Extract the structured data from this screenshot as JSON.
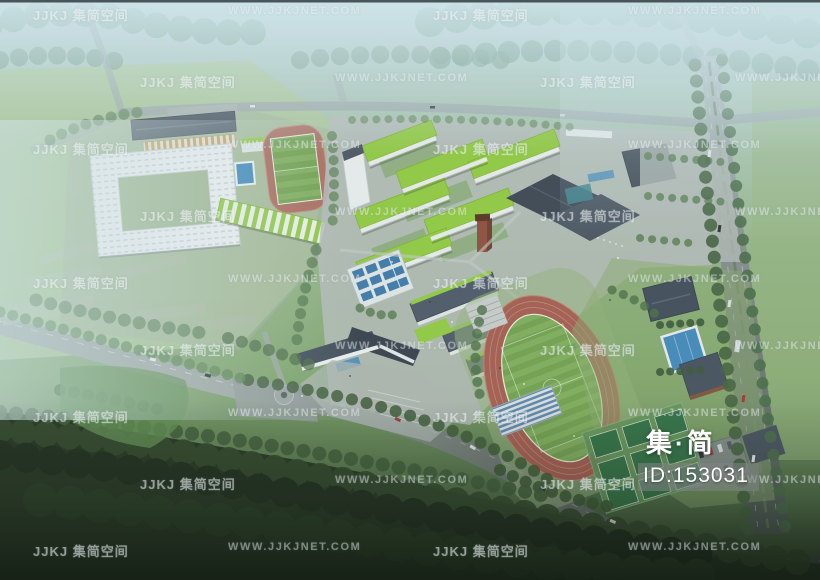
{
  "watermark": {
    "logo_text": "JJKJ 集简空间",
    "url_text": "WWW.JJKJNET.COM",
    "items": [
      {
        "type": "logo",
        "x": 33,
        "y": 5
      },
      {
        "type": "url",
        "x": 228,
        "y": 5
      },
      {
        "type": "logo",
        "x": 433,
        "y": 5
      },
      {
        "type": "url",
        "x": 628,
        "y": 5
      },
      {
        "type": "logo",
        "x": 140,
        "y": 72
      },
      {
        "type": "url",
        "x": 335,
        "y": 72
      },
      {
        "type": "logo",
        "x": 540,
        "y": 72
      },
      {
        "type": "url",
        "x": 735,
        "y": 72
      },
      {
        "type": "logo",
        "x": 33,
        "y": 139
      },
      {
        "type": "url",
        "x": 228,
        "y": 139
      },
      {
        "type": "logo",
        "x": 433,
        "y": 139
      },
      {
        "type": "url",
        "x": 628,
        "y": 139
      },
      {
        "type": "logo",
        "x": 140,
        "y": 206
      },
      {
        "type": "url",
        "x": 335,
        "y": 206
      },
      {
        "type": "logo",
        "x": 540,
        "y": 206
      },
      {
        "type": "url",
        "x": 735,
        "y": 206
      },
      {
        "type": "logo",
        "x": 33,
        "y": 273
      },
      {
        "type": "url",
        "x": 228,
        "y": 273
      },
      {
        "type": "logo",
        "x": 433,
        "y": 273
      },
      {
        "type": "url",
        "x": 628,
        "y": 273
      },
      {
        "type": "logo",
        "x": 140,
        "y": 340
      },
      {
        "type": "url",
        "x": 335,
        "y": 340
      },
      {
        "type": "logo",
        "x": 540,
        "y": 340
      },
      {
        "type": "url",
        "x": 735,
        "y": 340
      },
      {
        "type": "logo",
        "x": 33,
        "y": 407
      },
      {
        "type": "url",
        "x": 228,
        "y": 407
      },
      {
        "type": "logo",
        "x": 433,
        "y": 407
      },
      {
        "type": "url",
        "x": 628,
        "y": 407
      },
      {
        "type": "logo",
        "x": 140,
        "y": 474
      },
      {
        "type": "url",
        "x": 335,
        "y": 474
      },
      {
        "type": "logo",
        "x": 540,
        "y": 474
      },
      {
        "type": "url",
        "x": 735,
        "y": 474
      },
      {
        "type": "logo",
        "x": 33,
        "y": 541
      },
      {
        "type": "url",
        "x": 228,
        "y": 541
      },
      {
        "type": "logo",
        "x": 433,
        "y": 541
      },
      {
        "type": "url",
        "x": 628,
        "y": 541
      }
    ]
  },
  "overlay": {
    "brand": "集·简",
    "id": "ID:153031"
  },
  "palette": {
    "haze": "#cee4ea",
    "grass_light": "#a9c492",
    "grass_field": "#7cab58",
    "forest_dark": "#22331f",
    "track_red": "#a25a4c",
    "roof_green": "#8ec73e",
    "roof_slate": "#3e4a56",
    "pool_blue": "#3f86b7",
    "court_green": "#2e6e41",
    "road_gray": "#9aa5a6",
    "building_white": "#e9edee",
    "watermark_white": "#ffffff"
  }
}
